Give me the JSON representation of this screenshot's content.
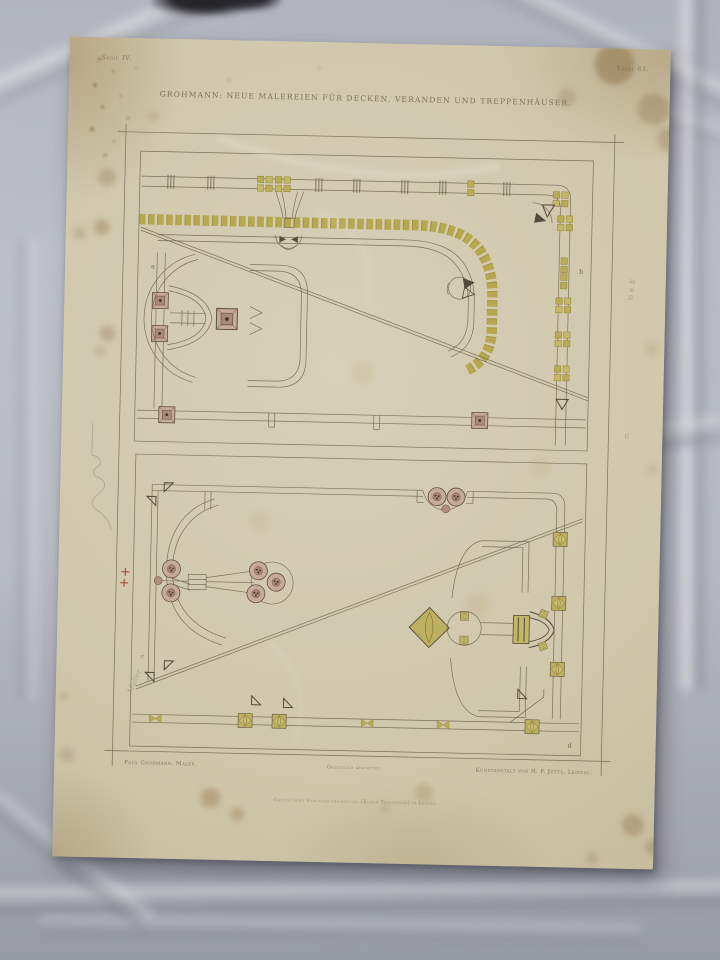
{
  "plate": {
    "serie": "Serie IV.",
    "tafel": "Tafel 61.",
    "title": "GROHMANN: NEUE MALEREIEN FÜR DECKEN, VERANDEN UND TREPPENHÄUSER.",
    "panel_labels": {
      "a": "a",
      "b": "b",
      "c": "c",
      "d": "d"
    },
    "captions": {
      "artist": "Paul Grohmann, Maler.",
      "rights": "Gesetzlich geschützt.",
      "printer": "Kunstanstalt von H. F. Jütte, Leipzig."
    },
    "imprint": "Gilbers'sche Verlagsbuchhandlung (Eugen Twietmeyer) in Leipzig.",
    "annotations": {
      "margin_right_pencil": "½ n. E.",
      "margin_left_pencil": "Müller",
      "margin_digit_pencil": "6"
    },
    "colors": {
      "paper": "#d0c7ac",
      "ink": "#6b6049",
      "ornament_gold": "#b5a84f",
      "ornament_mauve": "#c3a795",
      "red_mark": "#b23b34",
      "cloth": "#b6b9c1"
    }
  }
}
